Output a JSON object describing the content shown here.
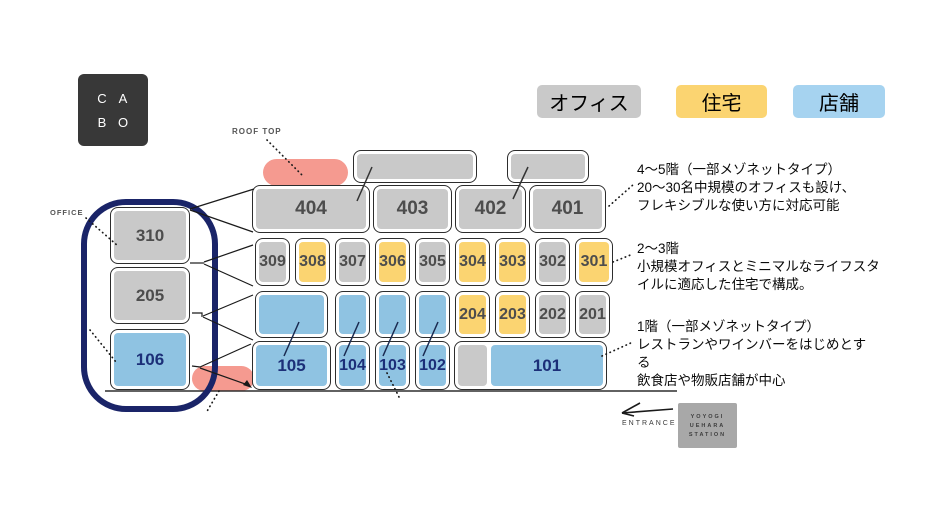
{
  "logo": {
    "letters": [
      "C",
      "A",
      "B",
      "O"
    ]
  },
  "legend": {
    "items": [
      {
        "label": "オフィス",
        "type": "office"
      },
      {
        "label": "住宅",
        "type": "residence"
      },
      {
        "label": "店舗",
        "type": "legend_shop"
      }
    ]
  },
  "labels": {
    "roof_top": "ROOF TOP",
    "office": "OFFICE",
    "entrance": "ENTRANCE"
  },
  "station": {
    "lines": [
      "YOYOGI",
      "UEHARA",
      "STATION"
    ]
  },
  "annotations": [
    {
      "lines": [
        "4〜5階（一部メゾネットタイプ）",
        "20〜30名中規模のオフィスも設け、",
        "フレキシブルな使い方に対応可能"
      ]
    },
    {
      "lines": [
        "2〜3階",
        "小規模オフィスとミニマルなライフスタ",
        "イルに適応した住宅で構成。"
      ]
    },
    {
      "lines": [
        "1階（一部メゾネットタイプ）",
        "レストランやワインバーをはじめとす",
        "る",
        "飲食店や物販店舗が中心"
      ]
    }
  ],
  "colors": {
    "office": "#c9c9c9",
    "residence": "#fbd471",
    "shop": "#8fc3e2",
    "legend_shop": "#a6d3f0",
    "pink": "#f59a90",
    "navy_outline": "#1a2468",
    "gray_text": "#4d4d4d",
    "shop_text": "#1c2f78"
  },
  "units": [
    {
      "id": "5f-left",
      "label": "",
      "type": "office",
      "x": 353,
      "y": 150,
      "w": 124,
      "h": 33,
      "fs": 14
    },
    {
      "id": "5f-right",
      "label": "",
      "type": "office",
      "x": 507,
      "y": 150,
      "w": 82,
      "h": 33,
      "fs": 14
    },
    {
      "id": "404",
      "label": "404",
      "type": "office",
      "x": 252,
      "y": 185,
      "w": 118,
      "h": 48,
      "fs": 19
    },
    {
      "id": "403",
      "label": "403",
      "type": "office",
      "x": 373,
      "y": 185,
      "w": 79,
      "h": 48,
      "fs": 19
    },
    {
      "id": "402",
      "label": "402",
      "type": "office",
      "x": 455,
      "y": 185,
      "w": 71,
      "h": 48,
      "fs": 19
    },
    {
      "id": "401",
      "label": "401",
      "type": "office",
      "x": 529,
      "y": 185,
      "w": 77,
      "h": 48,
      "fs": 19
    },
    {
      "id": "309",
      "label": "309",
      "type": "office",
      "x": 255,
      "y": 238,
      "w": 35,
      "h": 48,
      "fs": 16
    },
    {
      "id": "308",
      "label": "308",
      "type": "residence",
      "x": 295,
      "y": 238,
      "w": 35,
      "h": 48,
      "fs": 16
    },
    {
      "id": "307",
      "label": "307",
      "type": "office",
      "x": 335,
      "y": 238,
      "w": 35,
      "h": 48,
      "fs": 16
    },
    {
      "id": "306",
      "label": "306",
      "type": "residence",
      "x": 375,
      "y": 238,
      "w": 35,
      "h": 48,
      "fs": 16
    },
    {
      "id": "305",
      "label": "305",
      "type": "office",
      "x": 415,
      "y": 238,
      "w": 35,
      "h": 48,
      "fs": 16
    },
    {
      "id": "304",
      "label": "304",
      "type": "residence",
      "x": 455,
      "y": 238,
      "w": 35,
      "h": 48,
      "fs": 16
    },
    {
      "id": "303",
      "label": "303",
      "type": "residence",
      "x": 495,
      "y": 238,
      "w": 35,
      "h": 48,
      "fs": 16
    },
    {
      "id": "302",
      "label": "302",
      "type": "office",
      "x": 535,
      "y": 238,
      "w": 35,
      "h": 48,
      "fs": 16
    },
    {
      "id": "301",
      "label": "301",
      "type": "residence",
      "x": 575,
      "y": 238,
      "w": 38,
      "h": 48,
      "fs": 16
    },
    {
      "id": "2f-shop-1",
      "label": "",
      "type": "shop",
      "x": 255,
      "y": 291,
      "w": 73,
      "h": 47,
      "fs": 14
    },
    {
      "id": "2f-shop-2",
      "label": "",
      "type": "shop",
      "x": 335,
      "y": 291,
      "w": 35,
      "h": 47,
      "fs": 14
    },
    {
      "id": "2f-shop-3",
      "label": "",
      "type": "shop",
      "x": 375,
      "y": 291,
      "w": 35,
      "h": 47,
      "fs": 14
    },
    {
      "id": "2f-shop-4",
      "label": "",
      "type": "shop",
      "x": 415,
      "y": 291,
      "w": 35,
      "h": 47,
      "fs": 14
    },
    {
      "id": "204",
      "label": "204",
      "type": "residence",
      "x": 455,
      "y": 291,
      "w": 35,
      "h": 47,
      "fs": 16
    },
    {
      "id": "203",
      "label": "203",
      "type": "residence",
      "x": 495,
      "y": 291,
      "w": 35,
      "h": 47,
      "fs": 16
    },
    {
      "id": "202",
      "label": "202",
      "type": "office",
      "x": 535,
      "y": 291,
      "w": 35,
      "h": 47,
      "fs": 16
    },
    {
      "id": "201",
      "label": "201",
      "type": "office",
      "x": 575,
      "y": 291,
      "w": 35,
      "h": 47,
      "fs": 16
    },
    {
      "id": "105",
      "label": "105",
      "type": "shop",
      "x": 252,
      "y": 341,
      "w": 79,
      "h": 49,
      "fs": 17
    },
    {
      "id": "104",
      "label": "104",
      "type": "shop",
      "x": 335,
      "y": 341,
      "w": 35,
      "h": 49,
      "fs": 16
    },
    {
      "id": "103",
      "label": "103",
      "type": "shop",
      "x": 375,
      "y": 341,
      "w": 35,
      "h": 49,
      "fs": 16
    },
    {
      "id": "102",
      "label": "102",
      "type": "shop",
      "x": 415,
      "y": 341,
      "w": 35,
      "h": 49,
      "fs": 16
    },
    {
      "id": "1f-shell",
      "label": "",
      "shell": true,
      "x": 454,
      "y": 341,
      "w": 153,
      "h": 49
    },
    {
      "id": "1f-gray",
      "label": "",
      "type": "office",
      "inner": true,
      "x": 458,
      "y": 345,
      "w": 29,
      "h": 41,
      "fs": 14
    },
    {
      "id": "101",
      "label": "101",
      "type": "shop",
      "inner": true,
      "x": 491,
      "y": 345,
      "w": 112,
      "h": 41,
      "fs": 17
    },
    {
      "id": "310",
      "label": "310",
      "type": "office",
      "x": 110,
      "y": 207,
      "w": 80,
      "h": 57,
      "fs": 17
    },
    {
      "id": "205",
      "label": "205",
      "type": "office",
      "x": 110,
      "y": 267,
      "w": 80,
      "h": 57,
      "fs": 17
    },
    {
      "id": "106",
      "label": "106",
      "type": "shop",
      "x": 110,
      "y": 329,
      "w": 80,
      "h": 61,
      "fs": 17
    }
  ]
}
